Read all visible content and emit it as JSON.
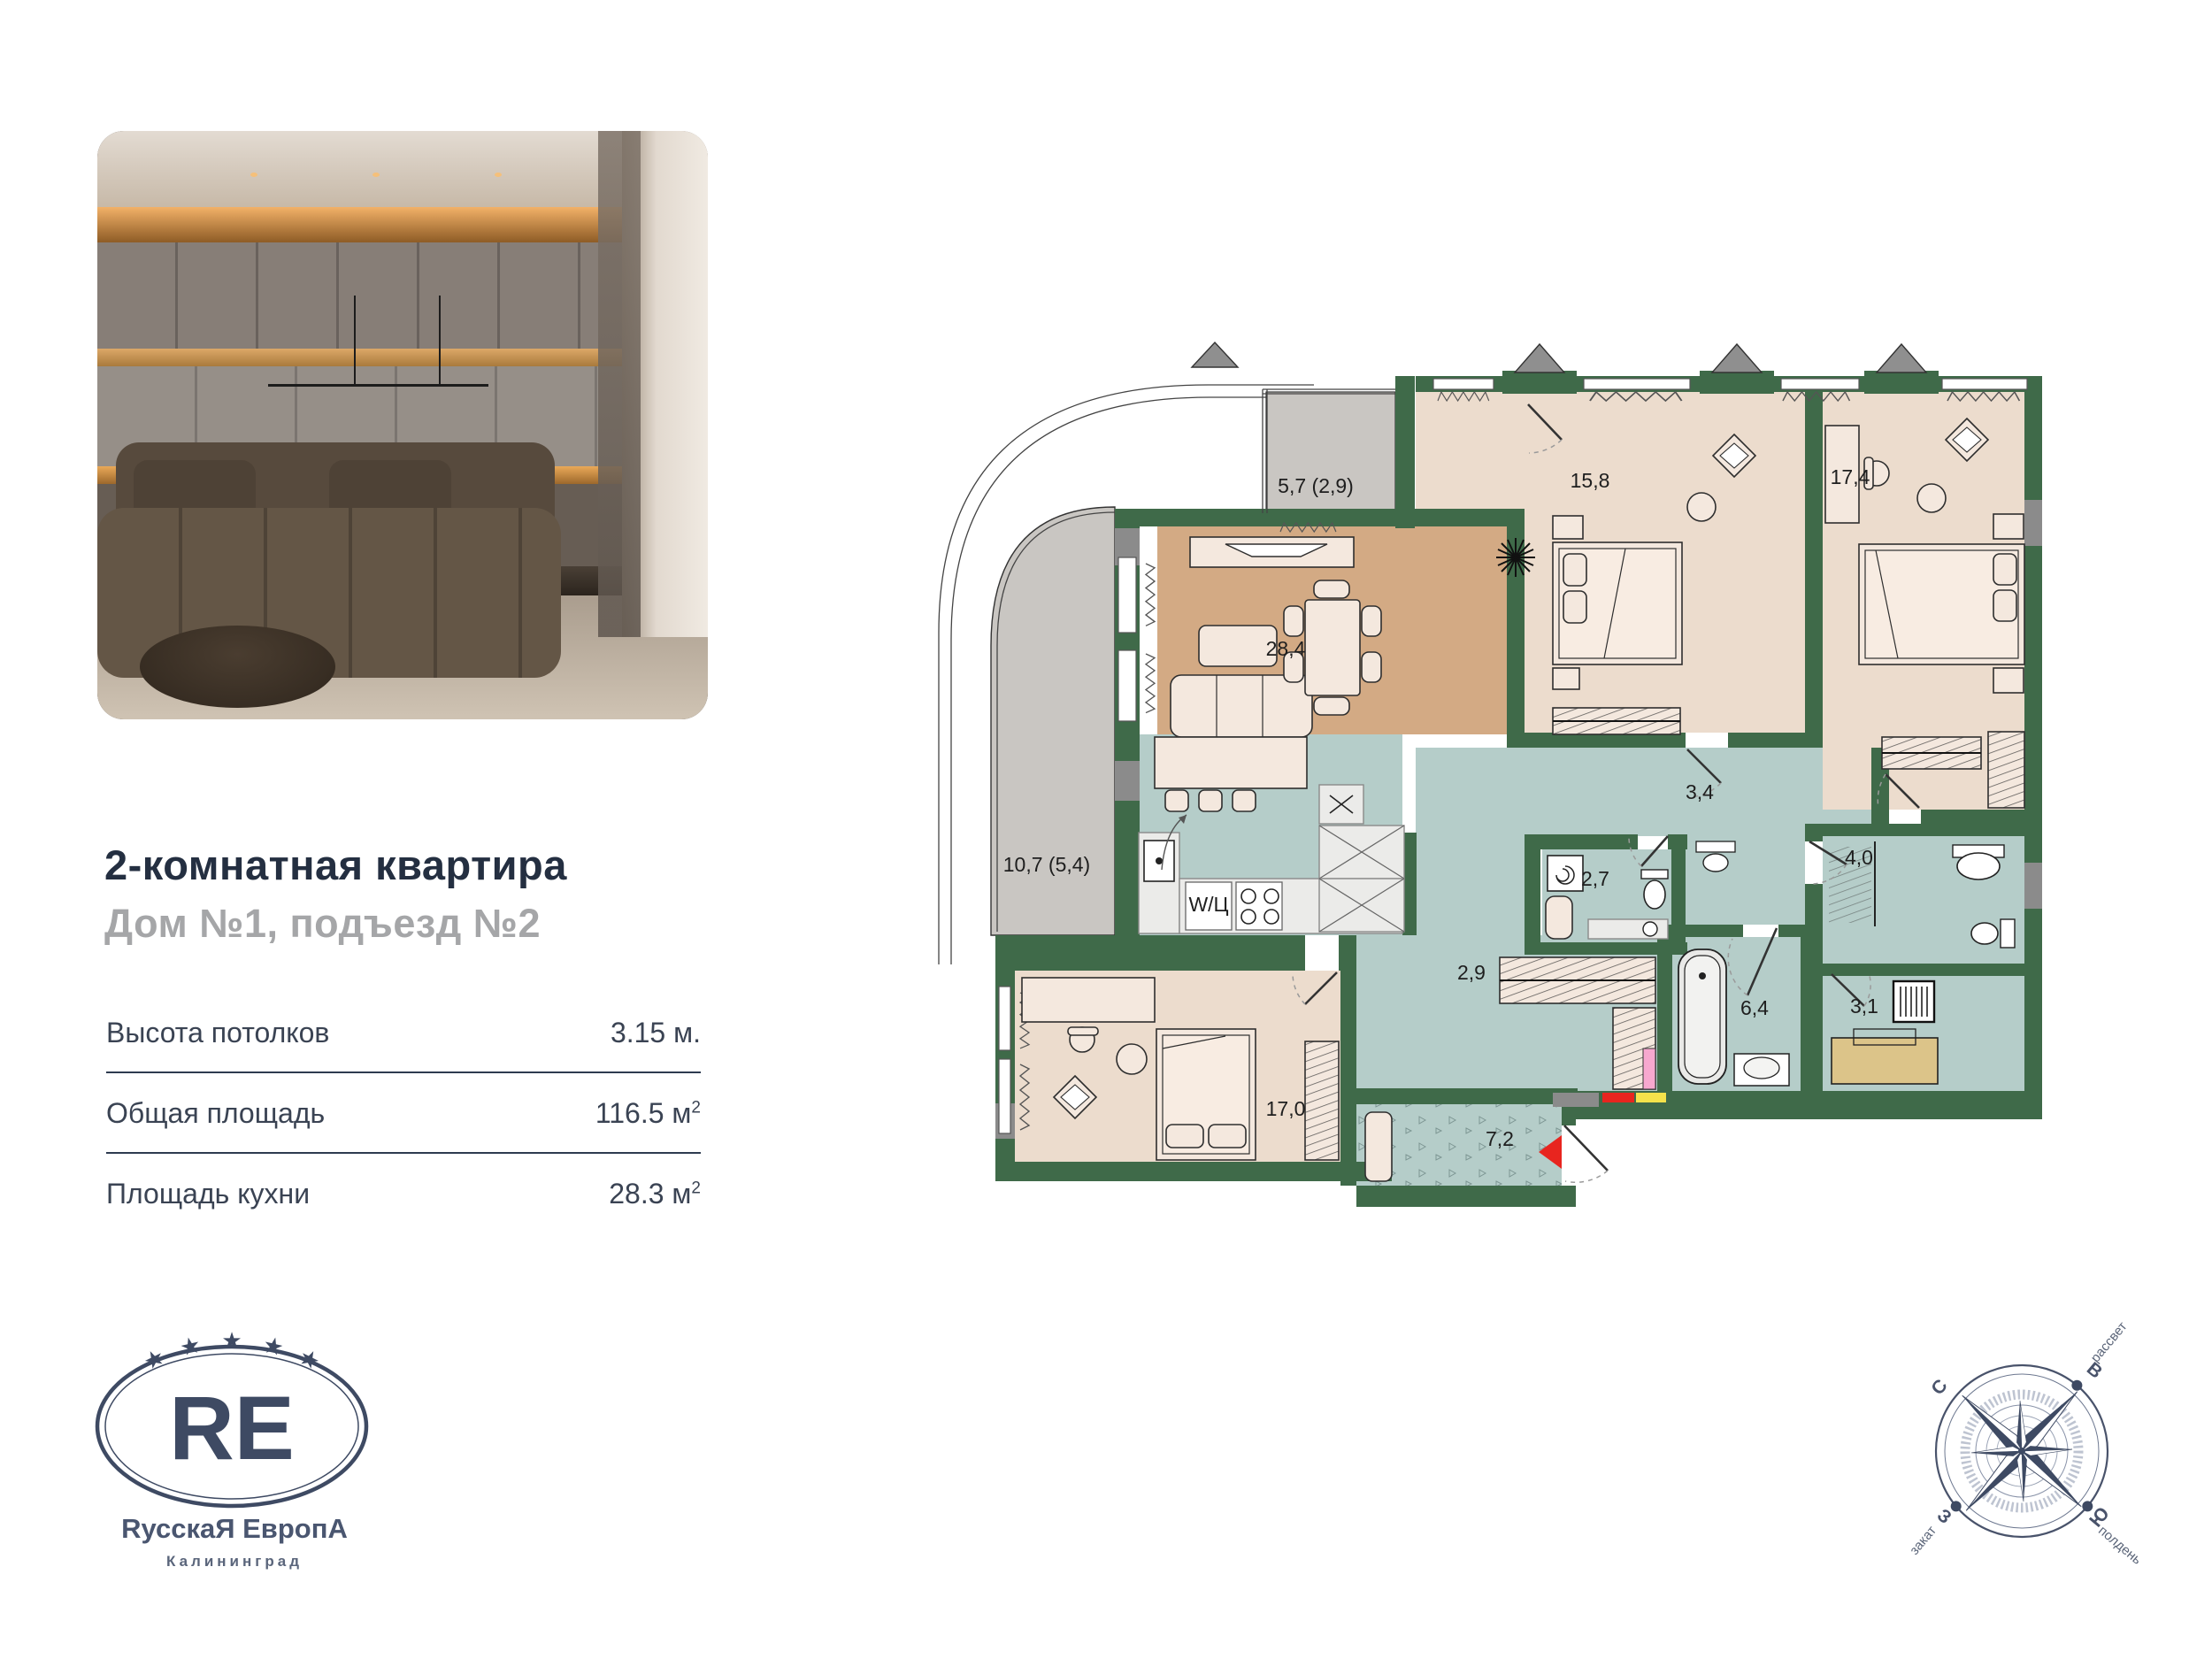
{
  "listing": {
    "title": "2-комнатная квартира",
    "subtitle": "Дом №1, подъезд №2",
    "specs": [
      {
        "label": "Высота потолков",
        "value": "3.15",
        "unit": " м.",
        "sup": ""
      },
      {
        "label": "Общая площадь",
        "value": "116.5",
        "unit": " м",
        "sup": "2"
      },
      {
        "label": "Площадь кухни",
        "value": "28.3",
        "unit": " м",
        "sup": "2"
      }
    ]
  },
  "logo": {
    "monogram": "RE",
    "star": "★",
    "wordmark": "RусскаЯ ЕвропА",
    "city": "Калининград"
  },
  "plan": {
    "appliance_label": "W/Ц",
    "rooms": [
      {
        "name": "balcony-top",
        "area": "5,7 (2,9)"
      },
      {
        "name": "bedroom-1",
        "area": "15,8"
      },
      {
        "name": "bedroom-2",
        "area": "17,4"
      },
      {
        "name": "living-kitchen",
        "area": "28,4"
      },
      {
        "name": "balcony-left",
        "area": "10,7 (5,4)"
      },
      {
        "name": "hallway",
        "area": "3,4"
      },
      {
        "name": "wc",
        "area": "2,7"
      },
      {
        "name": "bathroom-2",
        "area": "4,0"
      },
      {
        "name": "corridor",
        "area": "2,9"
      },
      {
        "name": "bathroom-1",
        "area": "6,4"
      },
      {
        "name": "utility",
        "area": "3,1"
      },
      {
        "name": "bedroom-3",
        "area": "17,0"
      },
      {
        "name": "entry-hall",
        "area": "7,2"
      }
    ],
    "colors": {
      "wall": "#3f6a49",
      "wet": "#b5cdc9",
      "living": "#d3aa84",
      "bedroom": "#ecdccd",
      "balcony": "#c9c6c2",
      "accent_red": "#e8251f"
    }
  },
  "compass": {
    "n": "С",
    "e": "В",
    "s": "Ю",
    "w": "З",
    "sunrise": "рассвет",
    "sunset": "закат",
    "noon": "полдень"
  }
}
